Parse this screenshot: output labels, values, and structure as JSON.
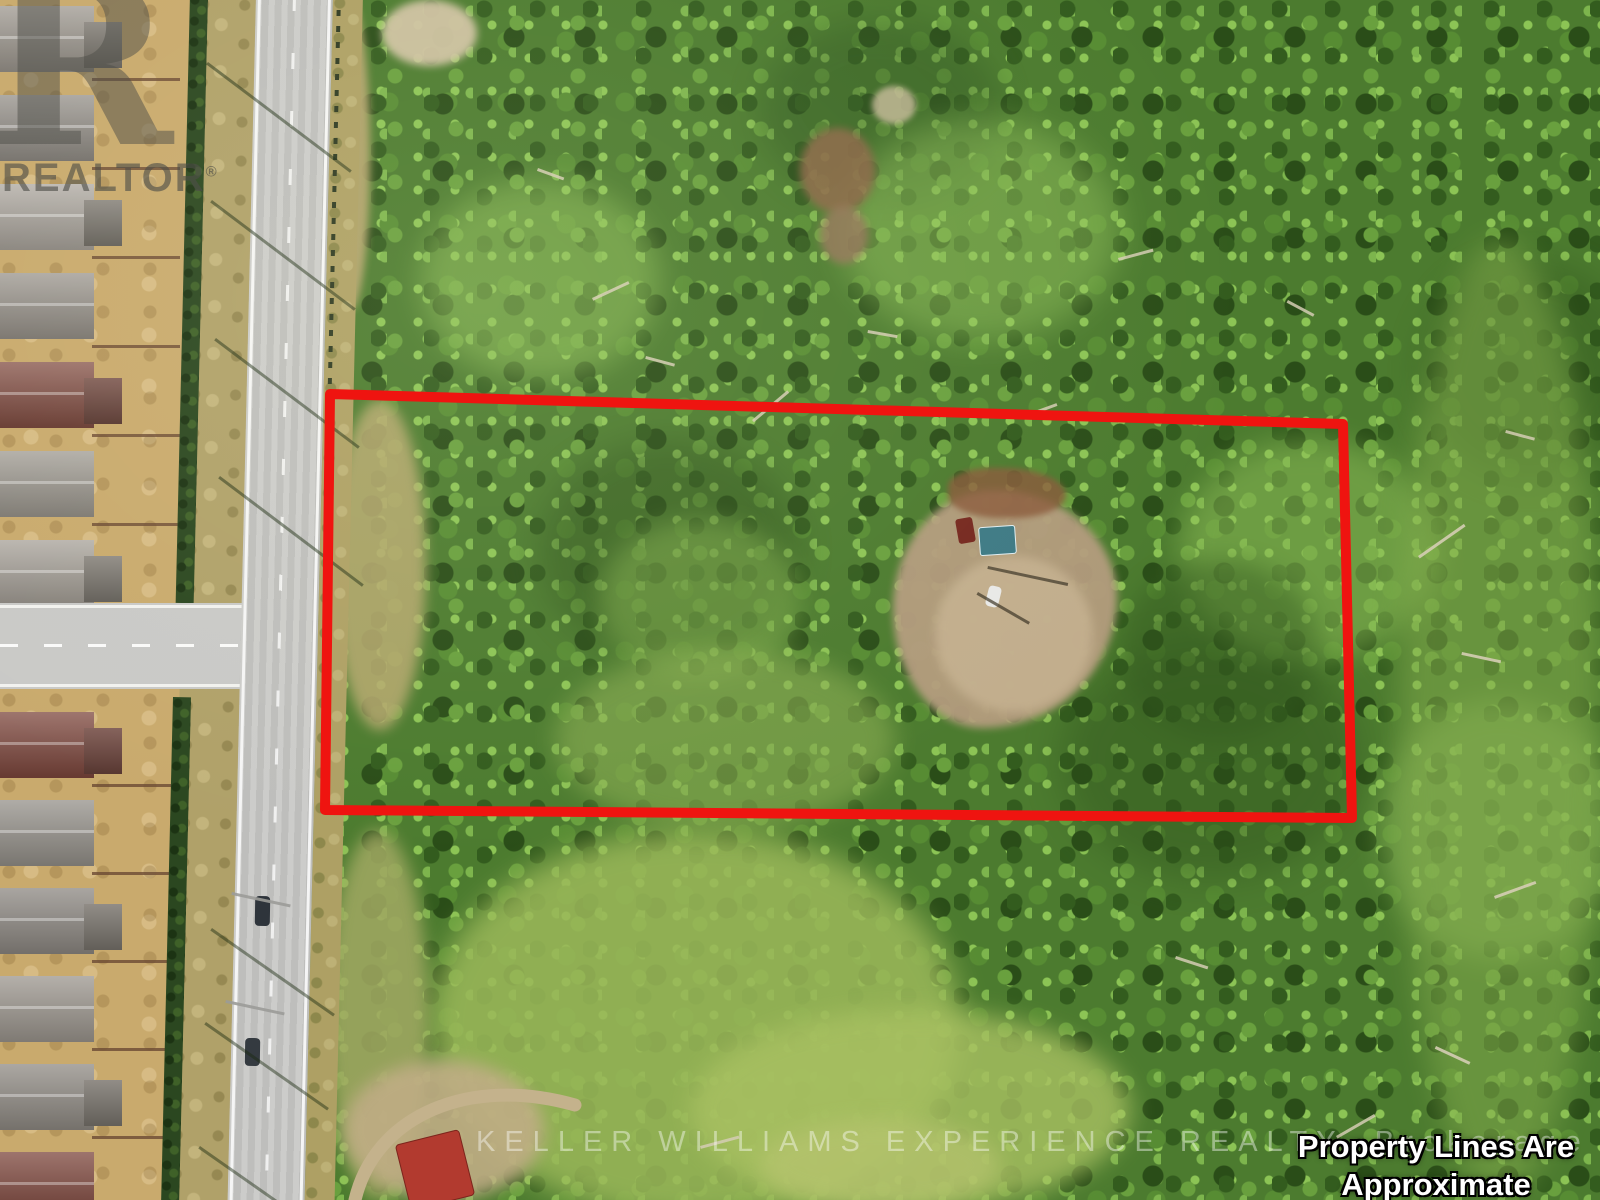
{
  "meta": {
    "description": "Aerial drone photo of a treed vacant-land property beside a road and subdivision, with red property outline",
    "width": 1600,
    "height": 1200
  },
  "watermark": {
    "logo_letter": "R",
    "realtor": "REALTOR",
    "reg": "®",
    "brokerage": "KELLER WILLIAMS EXPERIENCE REALTY, Brokerage",
    "disclaimer1": "Property Lines Are Approximate",
    "disclaimer2": "For Reference Only"
  },
  "outline": {
    "points": "330,394 1343,424 1352,818 325,810",
    "color": "#ef1410",
    "width": 10
  },
  "palette": {
    "forest": "#4c7b2f",
    "forest_dark": "#2f541d",
    "forest_light": "#7cb24c",
    "meadow": "#9cb95a",
    "road": "#c8c8c6",
    "shoulder": "#b0a169",
    "backyard": "#c9aa6d",
    "clearing": "#b49c7e",
    "red_line": "#ef1410",
    "roof_gray": "#95908a",
    "roof_red": "#7d463c",
    "hedge": "#2b4720",
    "pool": "#5fc6d5",
    "shed_roof": "#3e7a85",
    "building_red": "#b23a2f"
  },
  "scene": {
    "houses_top": [
      {
        "y": 6,
        "c": "#9a948c",
        "g": true
      },
      {
        "y": 95,
        "c": "#8f8a84",
        "g": false
      },
      {
        "y": 184,
        "c": "#a8a29b",
        "g": true
      },
      {
        "y": 273,
        "c": "#948e87",
        "g": false
      },
      {
        "y": 362,
        "c": "#7d463c",
        "g": true
      },
      {
        "y": 451,
        "c": "#99948c",
        "g": false
      },
      {
        "y": 540,
        "c": "#a39d95",
        "g": true
      }
    ],
    "houses_bottom": [
      {
        "y": 712,
        "c": "#7d463c",
        "g": true
      },
      {
        "y": 800,
        "c": "#949089",
        "g": false
      },
      {
        "y": 888,
        "c": "#8c8781",
        "g": true
      },
      {
        "y": 976,
        "c": "#9b958d",
        "g": false
      },
      {
        "y": 1064,
        "c": "#8f8a83",
        "g": true
      },
      {
        "y": 1152,
        "c": "#7d463c",
        "g": false
      }
    ],
    "blobs": [
      {
        "n": "canopy-shade",
        "x": 540,
        "y": 440,
        "w": 260,
        "h": 220,
        "c": "#2c4f1a",
        "o": 0.4,
        "b": 16
      },
      {
        "n": "canopy-shade",
        "x": 1060,
        "y": 640,
        "w": 300,
        "h": 240,
        "c": "#2c4f1a",
        "o": 0.38,
        "b": 18
      },
      {
        "n": "canopy-shade",
        "x": 760,
        "y": 20,
        "w": 240,
        "h": 180,
        "c": "#2e5520",
        "o": 0.4,
        "b": 16
      },
      {
        "n": "canopy-shade",
        "x": 1420,
        "y": 260,
        "w": 220,
        "h": 220,
        "c": "#2c4f1a",
        "o": 0.35,
        "b": 16
      },
      {
        "n": "canopy-light",
        "x": 420,
        "y": 180,
        "w": 240,
        "h": 200,
        "c": "#8fbf58",
        "o": 0.5,
        "b": 14
      },
      {
        "n": "canopy-light",
        "x": 840,
        "y": 120,
        "w": 280,
        "h": 220,
        "c": "#93c35c",
        "o": 0.45,
        "b": 16
      },
      {
        "n": "canopy-light",
        "x": 1180,
        "y": 440,
        "w": 260,
        "h": 220,
        "c": "#8fbf58",
        "o": 0.5,
        "b": 14
      },
      {
        "n": "canopy-light",
        "x": 1380,
        "y": 700,
        "w": 240,
        "h": 260,
        "c": "#96c160",
        "o": 0.45,
        "b": 14
      },
      {
        "n": "canopy-light",
        "x": 600,
        "y": 520,
        "w": 200,
        "h": 160,
        "c": "#88b551",
        "o": 0.45,
        "b": 12
      },
      {
        "n": "right-edge-light",
        "x": 1400,
        "y": 240,
        "w": 200,
        "h": 960,
        "c": "#85ad4d",
        "o": 0.5,
        "b": 14
      },
      {
        "n": "meadow",
        "x": 430,
        "y": 830,
        "w": 530,
        "h": 390,
        "c": "#9cb95a",
        "o": 0.85,
        "b": 14
      },
      {
        "n": "meadow",
        "x": 690,
        "y": 1010,
        "w": 440,
        "h": 200,
        "c": "#a9c162",
        "o": 0.8,
        "b": 12
      },
      {
        "n": "meadow",
        "x": 555,
        "y": 650,
        "w": 340,
        "h": 180,
        "c": "#8aad52",
        "o": 0.6,
        "b": 12
      },
      {
        "n": "meadow-bright",
        "x": 760,
        "y": 1120,
        "w": 240,
        "h": 90,
        "c": "#b7c46f",
        "o": 0.7,
        "b": 10
      },
      {
        "n": "grass-strip",
        "x": 328,
        "y": 830,
        "w": 100,
        "h": 370,
        "c": "#a2a963",
        "o": 0.85,
        "b": 8
      },
      {
        "n": "sand-patch",
        "x": 382,
        "y": 0,
        "w": 95,
        "h": 66,
        "c": "#cfc2a2",
        "o": 0.95,
        "b": 4
      },
      {
        "n": "dry-strip",
        "x": 332,
        "y": 0,
        "w": 38,
        "h": 310,
        "c": "#b3a46d",
        "o": 0.95,
        "b": 4
      },
      {
        "n": "dry-strip",
        "x": 334,
        "y": 400,
        "w": 92,
        "h": 330,
        "c": "#b7a96f",
        "o": 0.85,
        "b": 6
      },
      {
        "n": "brown-patch",
        "x": 800,
        "y": 128,
        "w": 75,
        "h": 85,
        "c": "#8d6848",
        "o": 0.85,
        "b": 4
      },
      {
        "n": "brown-patch",
        "x": 820,
        "y": 206,
        "w": 48,
        "h": 58,
        "c": "#96755a",
        "o": 0.8,
        "b": 4
      },
      {
        "n": "sand-patch",
        "x": 872,
        "y": 86,
        "w": 44,
        "h": 38,
        "c": "#c9bc9b",
        "o": 0.8,
        "b": 3
      },
      {
        "n": "dirt-area",
        "x": 344,
        "y": 1060,
        "w": 200,
        "h": 140,
        "c": "#c0ad85",
        "o": 0.9,
        "b": 8
      },
      {
        "n": "forest-shade",
        "x": 1120,
        "y": 560,
        "w": 200,
        "h": 180,
        "c": "#33591f",
        "o": 0.45,
        "b": 12
      },
      {
        "n": "clearing",
        "x": 893,
        "y": 490,
        "w": 224,
        "h": 238,
        "c": "#b49c7e",
        "o": 0.95,
        "b": 4,
        "r": "45% 55% 60% 40% / 50% 45% 55% 50%"
      },
      {
        "n": "clearing-light",
        "x": 935,
        "y": 556,
        "w": 158,
        "h": 156,
        "c": "#c6b291",
        "o": 0.85,
        "b": 5
      },
      {
        "n": "debris-pile",
        "x": 948,
        "y": 468,
        "w": 118,
        "h": 50,
        "c": "#8a5a3b",
        "o": 0.8,
        "b": 3,
        "r": "40% 60% 50% 50%"
      },
      {
        "n": "shed",
        "x": 979,
        "y": 526,
        "w": 35,
        "h": 27,
        "c": "#3e7a85",
        "o": 1,
        "r": "3px",
        "rot": -4,
        "bd": "1px solid #dfeef2"
      },
      {
        "n": "red-truck",
        "x": 957,
        "y": 518,
        "w": 17,
        "h": 25,
        "c": "#76281f",
        "o": 1,
        "r": "3px",
        "rot": -10
      },
      {
        "n": "white-car",
        "x": 987,
        "y": 586,
        "w": 13,
        "h": 21,
        "c": "#e9e9e7",
        "o": 1,
        "r": "4px",
        "rot": 14
      },
      {
        "n": "pool-deck",
        "x": 98,
        "y": 396,
        "w": 64,
        "h": 48,
        "c": "#d8d2c6",
        "o": 0.9,
        "b": 2,
        "r": "40%"
      },
      {
        "n": "swimming-pool",
        "x": 108,
        "y": 404,
        "w": 46,
        "h": 32,
        "c": "#5fc6d5",
        "o": 1,
        "b": 1,
        "r": "35% 65% 55% 45%",
        "rot": -8
      },
      {
        "n": "backyard-tree",
        "x": 146,
        "y": 58,
        "w": 26,
        "h": 22,
        "c": "#37591f",
        "o": 0.9,
        "b": 2
      },
      {
        "n": "backyard-tree",
        "x": 132,
        "y": 246,
        "w": 30,
        "h": 24,
        "c": "#37591f",
        "o": 0.9,
        "b": 2
      },
      {
        "n": "backyard-tree",
        "x": 156,
        "y": 326,
        "w": 24,
        "h": 20,
        "c": "#37591f",
        "o": 0.9,
        "b": 2
      },
      {
        "n": "backyard-tree",
        "x": 122,
        "y": 516,
        "w": 28,
        "h": 22,
        "c": "#37591f",
        "o": 0.9,
        "b": 2
      },
      {
        "n": "backyard-tree",
        "x": 138,
        "y": 756,
        "w": 26,
        "h": 22,
        "c": "#37591f",
        "o": 0.9,
        "b": 2
      },
      {
        "n": "backyard-tree",
        "x": 152,
        "y": 900,
        "w": 28,
        "h": 22,
        "c": "#37591f",
        "o": 0.9,
        "b": 2
      },
      {
        "n": "backyard-tree",
        "x": 128,
        "y": 1006,
        "w": 24,
        "h": 20,
        "c": "#37591f",
        "o": 0.9,
        "b": 2
      },
      {
        "n": "backyard-tree",
        "x": 146,
        "y": 1154,
        "w": 26,
        "h": 20,
        "c": "#37591f",
        "o": 0.9,
        "b": 2
      },
      {
        "n": "power-pole",
        "x": 212,
        "y": 88,
        "w": 5,
        "h": 5,
        "c": "#3a3a30",
        "o": 0.9
      },
      {
        "n": "power-pole",
        "x": 214,
        "y": 228,
        "w": 5,
        "h": 5,
        "c": "#3a3a30",
        "o": 0.9
      },
      {
        "n": "power-pole",
        "x": 216,
        "y": 368,
        "w": 5,
        "h": 5,
        "c": "#3a3a30",
        "o": 0.9
      },
      {
        "n": "power-pole",
        "x": 218,
        "y": 508,
        "w": 5,
        "h": 5,
        "c": "#3a3a30",
        "o": 0.9
      },
      {
        "n": "power-pole",
        "x": 208,
        "y": 792,
        "w": 5,
        "h": 5,
        "c": "#3a3a30",
        "o": 0.9
      },
      {
        "n": "power-pole",
        "x": 204,
        "y": 936,
        "w": 5,
        "h": 5,
        "c": "#3a3a30",
        "o": 0.9
      },
      {
        "n": "power-pole",
        "x": 200,
        "y": 1080,
        "w": 5,
        "h": 5,
        "c": "#3a3a30",
        "o": 0.9
      }
    ],
    "over_blobs": [
      {
        "n": "car-on-road",
        "x": 255,
        "y": 896,
        "w": 15,
        "h": 30,
        "c": "#2e343b",
        "o": 1,
        "r": "4px",
        "rot": 1
      },
      {
        "n": "car-on-road",
        "x": 245,
        "y": 1038,
        "w": 15,
        "h": 28,
        "c": "#343a40",
        "o": 1,
        "r": "4px",
        "rot": 1
      },
      {
        "n": "red-roof-building",
        "x": 402,
        "y": 1136,
        "w": 64,
        "h": 66,
        "c": "#b23a2f",
        "o": 1,
        "r": "4px",
        "rot": -14,
        "bd": "1px solid #7c241c"
      }
    ],
    "lines": [
      {
        "n": "pole-shadow",
        "x": 208,
        "y": 62,
        "l": 180,
        "t": 3,
        "a": 37,
        "c": "#1a2a10",
        "o": 0.5
      },
      {
        "n": "pole-shadow",
        "x": 212,
        "y": 200,
        "l": 180,
        "t": 3,
        "a": 37,
        "c": "#1a2a10",
        "o": 0.5
      },
      {
        "n": "pole-shadow",
        "x": 216,
        "y": 338,
        "l": 180,
        "t": 3,
        "a": 37,
        "c": "#1a2a10",
        "o": 0.5
      },
      {
        "n": "pole-shadow",
        "x": 220,
        "y": 476,
        "l": 180,
        "t": 3,
        "a": 37,
        "c": "#1a2a10",
        "o": 0.5
      },
      {
        "n": "pole-shadow",
        "x": 212,
        "y": 928,
        "l": 150,
        "t": 3,
        "a": 35,
        "c": "#1a2a10",
        "o": 0.45
      },
      {
        "n": "pole-shadow",
        "x": 206,
        "y": 1022,
        "l": 150,
        "t": 3,
        "a": 35,
        "c": "#1a2a10",
        "o": 0.45
      },
      {
        "n": "pole-shadow",
        "x": 200,
        "y": 1146,
        "l": 160,
        "t": 3,
        "a": 35,
        "c": "#1a2a10",
        "o": 0.45
      },
      {
        "n": "streetlight-arm",
        "x": 232,
        "y": 892,
        "l": 60,
        "t": 3,
        "a": 12,
        "c": "#9b9b98",
        "o": 0.9
      },
      {
        "n": "streetlight-arm",
        "x": 226,
        "y": 1000,
        "l": 60,
        "t": 3,
        "a": 12,
        "c": "#9b9b98",
        "o": 0.9
      },
      {
        "n": "fence-shadow",
        "x": 988,
        "y": 566,
        "l": 82,
        "t": 3,
        "a": 12,
        "c": "#3a3325",
        "o": 0.7
      },
      {
        "n": "fence-shadow",
        "x": 978,
        "y": 592,
        "l": 60,
        "t": 3,
        "a": 30,
        "c": "#3a3325",
        "o": 0.7
      },
      {
        "n": "dead-tree",
        "x": 592,
        "y": 298,
        "l": 40,
        "t": 3,
        "a": -25,
        "c": "#d5cdb4",
        "o": 0.85
      },
      {
        "n": "dead-tree",
        "x": 646,
        "y": 356,
        "l": 30,
        "t": 3,
        "a": 15,
        "c": "#d5cdb4",
        "o": 0.85
      },
      {
        "n": "dead-tree",
        "x": 752,
        "y": 420,
        "l": 46,
        "t": 3,
        "a": -40,
        "c": "#d5cdb4",
        "o": 0.85
      },
      {
        "n": "dead-tree",
        "x": 538,
        "y": 168,
        "l": 28,
        "t": 3,
        "a": 20,
        "c": "#d5cdb4",
        "o": 0.85
      },
      {
        "n": "dead-tree",
        "x": 1118,
        "y": 258,
        "l": 36,
        "t": 3,
        "a": -15,
        "c": "#d5cdb4",
        "o": 0.85
      },
      {
        "n": "dead-tree",
        "x": 1288,
        "y": 300,
        "l": 30,
        "t": 3,
        "a": 28,
        "c": "#d5cdb4",
        "o": 0.85
      },
      {
        "n": "dead-tree",
        "x": 1418,
        "y": 556,
        "l": 56,
        "t": 3,
        "a": -35,
        "c": "#d5cdb4",
        "o": 0.9
      },
      {
        "n": "dead-tree",
        "x": 1462,
        "y": 652,
        "l": 40,
        "t": 3,
        "a": 12,
        "c": "#d5cdb4",
        "o": 0.9
      },
      {
        "n": "dead-tree",
        "x": 1494,
        "y": 896,
        "l": 44,
        "t": 3,
        "a": -20,
        "c": "#d5cdb4",
        "o": 0.9
      },
      {
        "n": "dead-tree",
        "x": 1436,
        "y": 1046,
        "l": 38,
        "t": 3,
        "a": 25,
        "c": "#d5cdb4",
        "o": 0.9
      },
      {
        "n": "dead-tree",
        "x": 700,
        "y": 1146,
        "l": 40,
        "t": 3,
        "a": -15,
        "c": "#d5cdb4",
        "o": 0.85
      },
      {
        "n": "dead-tree",
        "x": 1176,
        "y": 956,
        "l": 34,
        "t": 3,
        "a": 18,
        "c": "#d5cdb4",
        "o": 0.85
      },
      {
        "n": "dead-tree",
        "x": 1336,
        "y": 1136,
        "l": 44,
        "t": 3,
        "a": -30,
        "c": "#d5cdb4",
        "o": 0.85
      },
      {
        "n": "dead-tree",
        "x": 868,
        "y": 330,
        "l": 30,
        "t": 3,
        "a": 10,
        "c": "#d5cdb4",
        "o": 0.85
      },
      {
        "n": "dead-tree",
        "x": 1032,
        "y": 412,
        "l": 26,
        "t": 3,
        "a": -20,
        "c": "#d5cdb4",
        "o": 0.85
      },
      {
        "n": "dead-tree",
        "x": 1506,
        "y": 430,
        "l": 30,
        "t": 3,
        "a": 15,
        "c": "#d5cdb4",
        "o": 0.85
      }
    ],
    "path": {
      "d": "M 355,1200 C 375,1115 470,1075 575,1105",
      "c": "#c4b28c",
      "w": 13
    }
  }
}
